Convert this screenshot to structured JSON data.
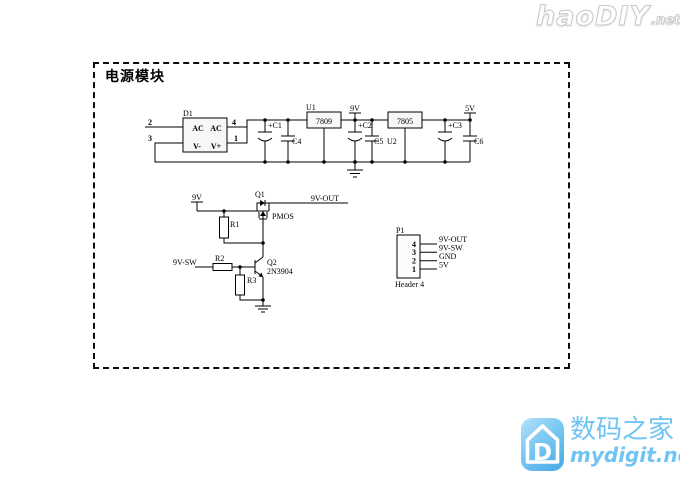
{
  "watermarks": {
    "top": {
      "brand": "haoDIY",
      "tld": ".net"
    },
    "bottom": {
      "icon_letter": "D",
      "brand_cn": "数码之家",
      "brand_en": "mydigit.net",
      "accent_color": "#6fc4f3"
    }
  },
  "schematic": {
    "title": "电源模块",
    "bridge": {
      "ref": "D1",
      "pins": {
        "p2": "2",
        "p3": "3",
        "p4": "4",
        "p1": "1"
      },
      "labels": {
        "ac1": "AC",
        "ac2": "AC",
        "vm": "V-",
        "vp": "V+"
      }
    },
    "u1": {
      "ref": "U1",
      "part": "7809"
    },
    "u2": {
      "ref": "U2",
      "part": "7805"
    },
    "caps": {
      "c1": "+C1",
      "c2": "+C2",
      "c3": "+C3",
      "c4": "C4",
      "c5": "C5",
      "c6": "C6"
    },
    "rails": {
      "v9": "9V",
      "v5": "5V",
      "v9_in": "9V",
      "v9_out": "9V-OUT",
      "v9_sw": "9V-SW"
    },
    "q1": {
      "ref": "Q1",
      "type": "PMOS"
    },
    "q2": {
      "ref": "Q2",
      "part": "2N3904"
    },
    "r": {
      "r1": "R1",
      "r2": "R2",
      "r3": "R3"
    },
    "p1": {
      "ref": "P1",
      "name": "Header 4",
      "pins": [
        "4",
        "3",
        "2",
        "1"
      ],
      "labels": [
        "9V-OUT",
        "9V-SW",
        "GND",
        "5V"
      ]
    }
  }
}
